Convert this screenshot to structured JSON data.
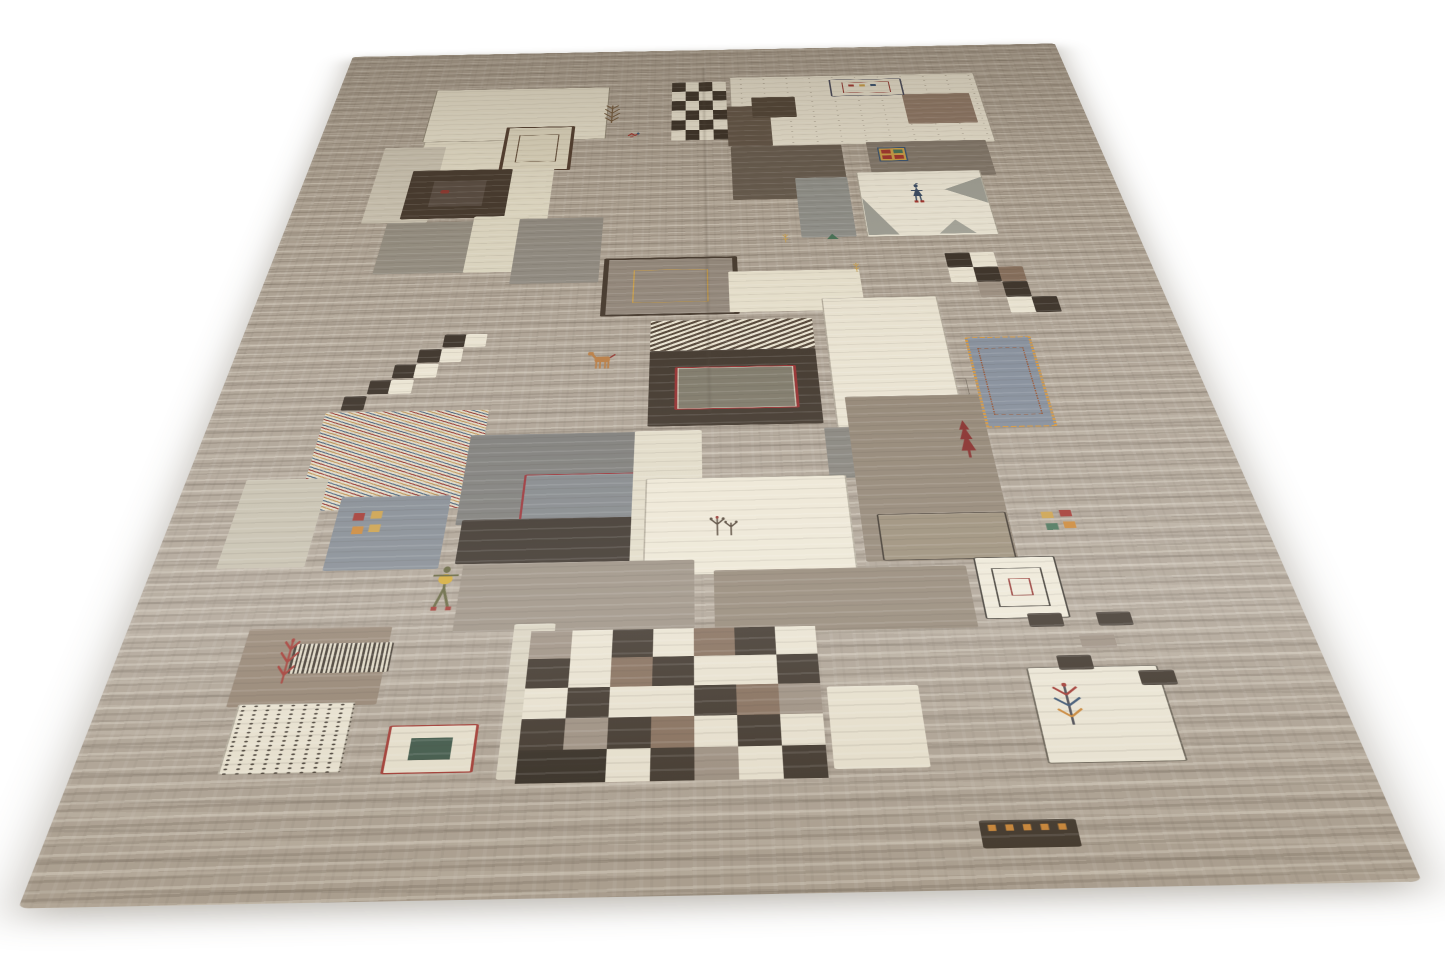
{
  "meta": {
    "domain": "natural-image",
    "subject": "Persian Gabbeh patchwork wool rug photographed in perspective on a white background",
    "background_color": "#ffffff"
  },
  "rug": {
    "field_color": "#a99d8e",
    "field_streak_light": "#e9e2d2",
    "field_streak_dark": "#5f5240",
    "palette": {
      "w": "#e9e2cf",
      "k": "#30261c",
      "br": "#7d6450",
      "gr": "#97897a",
      "kk": "#241c13"
    },
    "patches": [
      {
        "name": "ivory-patch-top-left",
        "type": "plain",
        "x": 13.4,
        "y": 8.0,
        "w": 23.7,
        "h": 10.6,
        "bg": "#e7e0cb",
        "outline": "rgba(70,58,44,0.55)"
      },
      {
        "name": "ivory-patch-top-left-lower",
        "type": "plain",
        "x": 13.7,
        "y": 18.6,
        "w": 14.8,
        "h": 13.4,
        "bg": "#e3dcc6",
        "outline": "rgba(70,58,44,0.35)"
      },
      {
        "name": "pale-column-left",
        "type": "plain",
        "x": 8.8,
        "y": 19.6,
        "w": 7.9,
        "h": 13.4,
        "bg": "#c9c1af"
      },
      {
        "name": "bordered-square-top-left",
        "type": "bordered",
        "x": 24.0,
        "y": 16.0,
        "w": 8.1,
        "h": 8.0,
        "bg": "#ddd5bd",
        "bw": 6,
        "bc": "#4a3526",
        "inner": {
          "inset": 18,
          "bw": 2,
          "bc": "#5a4430"
        }
      },
      {
        "name": "ivory-strip-left",
        "type": "plain",
        "x": 24.0,
        "y": 24.0,
        "w": 7.0,
        "h": 9.0,
        "bg": "#e0d9c3"
      },
      {
        "name": "dark-chocolate-square-left",
        "type": "plain",
        "x": 13.3,
        "y": 24.0,
        "w": 12.5,
        "h": 8.4,
        "bg": "#3e3125",
        "inner": {
          "inset": 24,
          "bw": 0,
          "bg": "#51443a"
        }
      },
      {
        "name": "gray-square-left",
        "type": "plain",
        "x": 12.0,
        "y": 33.0,
        "w": 11.5,
        "h": 8.0,
        "bg": "#8f887b"
      },
      {
        "name": "ivory-strip-left-2",
        "type": "plain",
        "x": 22.2,
        "y": 32.2,
        "w": 6.6,
        "h": 8.8,
        "bg": "#ddd6c0"
      },
      {
        "name": "slate-square-mid-left",
        "type": "plain",
        "x": 27.7,
        "y": 32.7,
        "w": 10.0,
        "h": 10.1,
        "bg": "#8b857b"
      },
      {
        "name": "checkerboard-top",
        "type": "checker",
        "x": 45.6,
        "y": 7.3,
        "w": 7.3,
        "h": 11.9,
        "cols": 4,
        "rows": 6,
        "map": [
          [
            "k",
            "w",
            "k",
            "w"
          ],
          [
            "w",
            "k",
            "w",
            "k"
          ],
          [
            "k",
            "w",
            "k",
            "w"
          ],
          [
            "w",
            "k",
            "w",
            "k"
          ],
          [
            "k",
            "w",
            "k",
            "w"
          ],
          [
            "w",
            "k",
            "w",
            "k"
          ]
        ]
      },
      {
        "name": "cream-field-top-right",
        "type": "plain",
        "x": 53.4,
        "y": 6.4,
        "w": 33.7,
        "h": 14.2,
        "bg": "#e9e2cf",
        "outline": "rgba(70,58,44,0.4)",
        "dots": {
          "color": "rgba(64,50,36,0.5)",
          "r": 1.2,
          "gapx": 44,
          "gapy": 34
        }
      },
      {
        "name": "dark-column-top",
        "type": "plain",
        "x": 52.9,
        "y": 12.6,
        "w": 5.7,
        "h": 8.0,
        "bg": "#5a4c3e"
      },
      {
        "name": "dark-rect-top-right",
        "type": "plain",
        "x": 56.3,
        "y": 10.8,
        "w": 5.8,
        "h": 4.2,
        "bg": "#473a2c"
      },
      {
        "name": "brown-square-top-right",
        "type": "plain",
        "x": 76.6,
        "y": 10.7,
        "w": 9.0,
        "h": 6.1,
        "bg": "#8a7260"
      },
      {
        "name": "mini-rug-top",
        "type": "bordered",
        "x": 67.0,
        "y": 7.3,
        "w": 9.5,
        "h": 3.4,
        "bg": "#e8e1cd",
        "bw": 3,
        "bc": "#3c3e50",
        "inner": {
          "inset": 16,
          "bw": 2,
          "bc": "#8e2b25"
        }
      },
      {
        "name": "dark-taupe-band",
        "type": "plain",
        "x": 53.2,
        "y": 20.6,
        "w": 14.1,
        "h": 9.6,
        "bg": "#605447"
      },
      {
        "name": "window-band",
        "type": "plain",
        "x": 70.5,
        "y": 20.2,
        "w": 15.3,
        "h": 6.5,
        "bg": "#7d7265"
      },
      {
        "name": "white-figure-patch",
        "type": "plain",
        "x": 68.6,
        "y": 25.8,
        "w": 15.4,
        "h": 10.9,
        "bg": "#eae4d3",
        "outline": "rgba(70,58,44,0.4)"
      },
      {
        "name": "gray-blue-square-top-right",
        "type": "plain",
        "x": 61.0,
        "y": 26.6,
        "w": 6.4,
        "h": 10.0,
        "bg": "#8a8a84"
      },
      {
        "name": "outline-rect-field",
        "type": "outline",
        "x": 61.0,
        "y": 56.5,
        "w": 15.0,
        "h": 2.0,
        "bw": 1.5,
        "bc": "rgba(55,45,35,0.55)"
      },
      {
        "name": "bordered-square-center",
        "type": "bordered",
        "x": 38.2,
        "y": 39.3,
        "w": 14.0,
        "h": 7.9,
        "bg": "#8d8174",
        "bw": 8,
        "bc": "#3c2f23",
        "inner": {
          "inset": 20,
          "bw": 2,
          "bc": "#c89a3f"
        }
      },
      {
        "name": "cream-patch-mid",
        "type": "plain",
        "x": 52.3,
        "y": 41.6,
        "w": 14.7,
        "h": 5.8,
        "bg": "#e6dfca"
      },
      {
        "name": "ivory-patch-right",
        "type": "plain",
        "x": 62.4,
        "y": 45.7,
        "w": 12.7,
        "h": 16.3,
        "bg": "#e8e1ce",
        "outline": "rgba(70,58,44,0.35)"
      },
      {
        "name": "zigzag-band",
        "type": "stripes",
        "x": 43.7,
        "y": 48.4,
        "w": 17.4,
        "h": 4.0,
        "angle": 135,
        "stripes": [
          [
            "#e8e1cd",
            7
          ],
          [
            "#4a3b2c",
            7
          ]
        ]
      },
      {
        "name": "dark-block-center",
        "type": "plain",
        "x": 43.7,
        "y": 52.4,
        "w": 17.4,
        "h": 9.1,
        "bg": "#352a1f"
      },
      {
        "name": "red-bordered-rect-center",
        "type": "bordered",
        "x": 46.4,
        "y": 54.5,
        "w": 11.9,
        "h": 4.9,
        "bg": "#76705f",
        "bw": 4,
        "bc": "#8e2323",
        "outline": "rgba(216,208,186,0.8)"
      },
      {
        "name": "slate-small-patch",
        "type": "plain",
        "x": 61.1,
        "y": 62.0,
        "w": 4.3,
        "h": 5.5,
        "bg": "#7f7c74"
      },
      {
        "name": "taupe-region-right",
        "type": "plain",
        "x": 63.5,
        "y": 58.5,
        "w": 13.5,
        "h": 17.2,
        "bg": "#8b7d6b"
      },
      {
        "name": "line-rect-taupe",
        "type": "outline",
        "x": 65.0,
        "y": 71.2,
        "w": 11.6,
        "h": 4.3,
        "bw": 2,
        "bc": "#32291f",
        "bg": "#94866f"
      },
      {
        "name": "gold-bordered-gray-rect",
        "type": "bordered",
        "x": 77.0,
        "y": 51.4,
        "w": 6.4,
        "h": 10.7,
        "bg": "#7e8794",
        "bw": 4,
        "bc": "#cf8f35",
        "dashed": true,
        "inner": {
          "inset": 12,
          "bw": 2,
          "bc": "#8e4a28",
          "dashed": true
        }
      },
      {
        "name": "pinstripe-patch",
        "type": "stripes",
        "x": 11.4,
        "y": 59.2,
        "w": 16.4,
        "h": 10.6,
        "angle": 40,
        "stripes": [
          [
            "#ddd5c0",
            5
          ],
          [
            "#b98c4a",
            3
          ],
          [
            "#ddd5c0",
            5
          ],
          [
            "#8e2b25",
            3
          ],
          [
            "#ddd5c0",
            5
          ],
          [
            "#3e5a74",
            3
          ]
        ]
      },
      {
        "name": "slate-big-square",
        "type": "plain",
        "x": 26.4,
        "y": 62.1,
        "w": 16.3,
        "h": 9.4,
        "bg": "#757470"
      },
      {
        "name": "red-bordered-rect-slate",
        "type": "bordered",
        "x": 32.2,
        "y": 66.5,
        "w": 10.2,
        "h": 4.7,
        "bg": "#7b7f82",
        "bw": 3.5,
        "bc": "#93262b"
      },
      {
        "name": "blue-flower-square",
        "type": "plain",
        "x": 15.3,
        "y": 68.5,
        "w": 10.3,
        "h": 7.1,
        "bg": "#7c838b"
      },
      {
        "name": "black-band",
        "type": "plain",
        "x": 27.0,
        "y": 71.0,
        "w": 23.0,
        "h": 4.2,
        "bg": "#2e251c"
      },
      {
        "name": "cream-column-center",
        "type": "plain",
        "x": 42.5,
        "y": 62.0,
        "w": 6.6,
        "h": 13.5,
        "bg": "#e0d9c4"
      },
      {
        "name": "ivory-big-patch",
        "type": "plain",
        "x": 43.7,
        "y": 67.2,
        "w": 19.0,
        "h": 9.4,
        "bg": "#ece5d2",
        "outline": "rgba(70,58,44,0.35)"
      },
      {
        "name": "pale-patch-left-mid",
        "type": "plain",
        "x": 5.8,
        "y": 66.5,
        "w": 7.8,
        "h": 8.7,
        "bg": "#c3bca9"
      },
      {
        "name": "taupe-patch-mid-left",
        "type": "plain",
        "x": 27.8,
        "y": 75.2,
        "w": 20.5,
        "h": 6.0,
        "bg": "#95897a"
      },
      {
        "name": "taupe-block-bottom",
        "type": "plain",
        "x": 50.0,
        "y": 76.2,
        "w": 22.2,
        "h": 5.4,
        "bg": "#8c7e6c"
      },
      {
        "name": "pale-sliver",
        "type": "plain",
        "x": 33.0,
        "y": 80.6,
        "w": 3.5,
        "h": 11.8,
        "bg": "#d8d1bd"
      },
      {
        "name": "brown-square-red-tree",
        "type": "plain",
        "x": 10.5,
        "y": 80.6,
        "w": 12.1,
        "h": 6.2,
        "bg": "#8d7b68"
      },
      {
        "name": "herringbone-band",
        "type": "stripes",
        "x": 14.7,
        "y": 81.9,
        "w": 8.3,
        "h": 2.4,
        "angle": 90,
        "stripes": [
          [
            "#332a20",
            2.5
          ],
          [
            "#ddd5c0",
            3
          ]
        ]
      },
      {
        "name": "checkerboard-big",
        "type": "checker",
        "x": 34.5,
        "y": 81.2,
        "w": 24.0,
        "h": 11.5,
        "cols": 7,
        "rows": 5,
        "map": [
          [
            "gr",
            "w",
            "k",
            "w",
            "br",
            "k",
            "w"
          ],
          [
            "k",
            "w",
            "br",
            "k",
            "w",
            "w",
            "k"
          ],
          [
            "w",
            "k",
            "w",
            "w",
            "k",
            "br",
            "gr"
          ],
          [
            "k",
            "gr",
            "k",
            "br",
            "w",
            "k",
            "w"
          ],
          [
            "kk",
            "kk",
            "w",
            "k",
            "gr",
            "w",
            "k"
          ]
        ]
      },
      {
        "name": "dotted-square",
        "type": "plain",
        "x": 11.4,
        "y": 86.6,
        "w": 9.5,
        "h": 5.1,
        "bg": "#e9e2cf",
        "outline": "rgba(70,58,44,0.35)",
        "dots": {
          "color": "rgba(40,32,24,0.9)",
          "r": 1.6,
          "gapx": 14,
          "gapy": 11
        }
      },
      {
        "name": "mini-rug-bottom",
        "type": "bordered",
        "x": 24.0,
        "y": 88.4,
        "w": 6.7,
        "h": 3.3,
        "bg": "#e7e0cc",
        "bw": 3,
        "bc": "#9c2b24",
        "inner": {
          "inset": 26,
          "bw": 0,
          "bg": "#2e4a3a"
        }
      },
      {
        "name": "ivory-patch-bottom",
        "type": "plain",
        "x": 59.0,
        "y": 86.1,
        "w": 7.4,
        "h": 6.0,
        "bg": "#e8e1cd"
      },
      {
        "name": "mini-rug-right",
        "type": "bordered",
        "x": 73.0,
        "y": 75.5,
        "w": 6.9,
        "h": 5.3,
        "bg": "#ece6d4",
        "bw": 2,
        "bc": "#2f2a22",
        "inner": {
          "inset": 18,
          "bw": 2,
          "bc": "#2f2a22"
        },
        "inner2": {
          "inset": 36,
          "bw": 2,
          "bc": "#8e2b25"
        }
      },
      {
        "name": "white-corner-patch",
        "type": "plain",
        "x": 75.4,
        "y": 84.9,
        "w": 10.8,
        "h": 7.1,
        "bg": "#ece6d4",
        "outline": "rgba(50,41,31,0.75)"
      },
      {
        "name": "stepped-cells-right",
        "type": "cells",
        "cell": {
          "w": 2.8,
          "h": 2.2
        },
        "items": [
          [
            77.1,
            39.4,
            "k"
          ],
          [
            79.9,
            39.4,
            "w"
          ],
          [
            77.1,
            41.6,
            "w"
          ],
          [
            79.9,
            41.6,
            "k"
          ],
          [
            82.7,
            41.6,
            "br"
          ],
          [
            79.9,
            43.8,
            "gr"
          ],
          [
            82.7,
            43.8,
            "k"
          ],
          [
            82.7,
            46.0,
            "w"
          ],
          [
            85.4,
            46.0,
            "k"
          ]
        ]
      },
      {
        "name": "trail-cells-left",
        "type": "cells",
        "cell": {
          "w": 2.3,
          "h": 1.7
        },
        "items": [
          [
            21.7,
            49.7,
            "k"
          ],
          [
            24.0,
            49.7,
            "w"
          ],
          [
            19.4,
            51.6,
            "k"
          ],
          [
            21.7,
            51.6,
            "w"
          ],
          [
            17.2,
            53.5,
            "k"
          ],
          [
            19.4,
            53.5,
            "w"
          ],
          [
            15.0,
            55.4,
            "k"
          ],
          [
            17.2,
            55.4,
            "w"
          ],
          [
            12.8,
            57.3,
            "k"
          ]
        ]
      },
      {
        "name": "black-cells-right",
        "type": "cells",
        "cell": {
          "w": 2.9,
          "h": 1.15
        },
        "items": [
          [
            76.6,
            80.5,
            "k"
          ],
          [
            82.4,
            80.5,
            "k"
          ],
          [
            80.5,
            82.3,
            "gr"
          ],
          [
            78.1,
            84.0,
            "k"
          ],
          [
            84.5,
            85.3,
            "k"
          ]
        ]
      },
      {
        "name": "dark-strip-bottom",
        "type": "plain",
        "x": 69.3,
        "y": 95.7,
        "w": 7.2,
        "h": 1.8,
        "bg": "#33291e"
      }
    ],
    "motifs": [
      {
        "type": "tree",
        "name": "tree-motif-top",
        "x": 36.2,
        "y": 11.4,
        "w": 3.0,
        "h": 4.2,
        "colors": [
          "#6b5134"
        ]
      },
      {
        "type": "bird",
        "name": "red-bird-motif",
        "x": 39.8,
        "y": 17.3,
        "w": 1.8,
        "h": 1.4,
        "colors": [
          "#9c2b24",
          "#2e4a6b"
        ]
      },
      {
        "type": "mark",
        "name": "red-mark-dark-square",
        "x": 17.0,
        "y": 27.2,
        "w": 1.8,
        "h": 1.3,
        "colors": [
          "#8e2b25"
        ]
      },
      {
        "type": "dash3",
        "name": "mini-rug-top-dashes",
        "x": 69.3,
        "y": 8.2,
        "w": 4.5,
        "h": 0.9,
        "colors": [
          "#9c2b24",
          "#c89a3f",
          "#2e4a6b"
        ]
      },
      {
        "type": "window",
        "name": "window-motif",
        "x": 71.8,
        "y": 21.3,
        "w": 3.6,
        "h": 2.6,
        "colors": [
          "#c89a3f",
          "#9c2b24",
          "#3e6a4e",
          "#9c2b24",
          "#2e4a6b"
        ]
      },
      {
        "type": "triangles",
        "name": "gray-angular-shapes",
        "x": 68.8,
        "y": 26.2,
        "w": 15.0,
        "h": 10.2,
        "colors": [
          "#9a9a90"
        ]
      },
      {
        "type": "person",
        "name": "person-motif",
        "x": 74.6,
        "y": 27.9,
        "w": 2.0,
        "h": 3.5,
        "colors": [
          "#31435c",
          "#9c2b24"
        ]
      },
      {
        "type": "sprig",
        "name": "gold-sprig",
        "x": 58.3,
        "y": 35.6,
        "w": 1.5,
        "h": 1.8,
        "colors": [
          "#c89a3f"
        ]
      },
      {
        "type": "tri",
        "name": "green-triangle",
        "x": 63.8,
        "y": 36.0,
        "w": 1.5,
        "h": 1.0,
        "colors": [
          "#3e6a4e"
        ]
      },
      {
        "type": "sprig",
        "name": "gold-sprig-2",
        "x": 66.0,
        "y": 40.3,
        "w": 1.5,
        "h": 1.8,
        "colors": [
          "#c89a3f"
        ]
      },
      {
        "type": "horse",
        "name": "horse-motif",
        "x": 37.2,
        "y": 52.3,
        "w": 3.2,
        "h": 2.3,
        "colors": [
          "#b5763a",
          "#8e2b25"
        ]
      },
      {
        "type": "pine",
        "name": "red-pine-motif",
        "x": 73.8,
        "y": 61.3,
        "w": 2.0,
        "h": 4.3,
        "colors": [
          "#7e1f1c"
        ]
      },
      {
        "type": "flower4",
        "name": "flower-cluster-left",
        "x": 16.6,
        "y": 69.8,
        "w": 3.4,
        "h": 2.8,
        "colors": [
          "#9c2b24",
          "#c89a3f",
          "#c87f2a",
          "#c89a3f"
        ]
      },
      {
        "type": "flower4",
        "name": "flower-cluster-right",
        "x": 79.8,
        "y": 71.0,
        "w": 3.6,
        "h": 2.4,
        "colors": [
          "#c89a3f",
          "#9c2b24",
          "#3e6a4e",
          "#c87f2a"
        ]
      },
      {
        "type": "sprig2",
        "name": "plant-motif-ivory",
        "x": 49.3,
        "y": 70.4,
        "w": 3.2,
        "h": 2.7,
        "colors": [
          "#4a3b2c",
          "#8e2b25"
        ]
      },
      {
        "type": "person2",
        "name": "figure-with-disc",
        "x": 25.0,
        "y": 75.3,
        "w": 2.8,
        "h": 4.2,
        "colors": [
          "#5a5a30",
          "#d2a52a",
          "#9c2b24"
        ]
      },
      {
        "type": "treeRed",
        "name": "red-plant-motif",
        "x": 13.2,
        "y": 81.0,
        "w": 2.5,
        "h": 4.1,
        "colors": [
          "#9c2b24"
        ]
      },
      {
        "type": "treeColor",
        "name": "colorful-tree-motif",
        "x": 76.6,
        "y": 86.0,
        "w": 3.2,
        "h": 3.4,
        "colors": [
          "#9c2b24",
          "#2e4a6b",
          "#c87f2a",
          "#3a3a44"
        ]
      },
      {
        "type": "dash",
        "name": "orange-ticks-bottom",
        "x": 69.6,
        "y": 95.8,
        "w": 6.5,
        "h": 0.8,
        "colors": [
          "#c87f2a"
        ]
      }
    ]
  }
}
